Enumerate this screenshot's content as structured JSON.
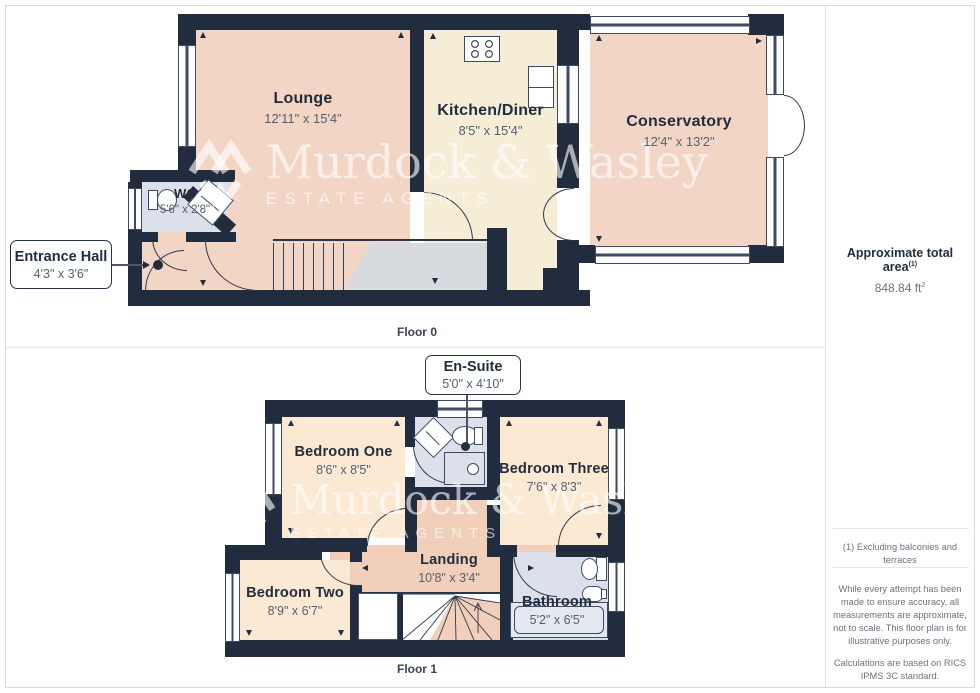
{
  "floor0": {
    "label": "Floor 0",
    "rooms": {
      "lounge": {
        "name": "Lounge",
        "dims": "12'11\" x 15'4\""
      },
      "kitchen": {
        "name": "Kitchen/Diner",
        "dims": "8'5\" x 15'4\""
      },
      "conservatory": {
        "name": "Conservatory",
        "dims": "12'4\" x 13'2\""
      },
      "wc": {
        "name": "WC",
        "dims": "5'6\" x 2'8\""
      },
      "entrance": {
        "name": "Entrance Hall",
        "dims": "4'3\" x 3'6\""
      }
    }
  },
  "floor1": {
    "label": "Floor 1",
    "rooms": {
      "ensuite": {
        "name": "En-Suite",
        "dims": "5'0\" x 4'10\""
      },
      "bedroom1": {
        "name": "Bedroom One",
        "dims": "8'6\" x 8'5\""
      },
      "bedroom3": {
        "name": "Bedroom Three",
        "dims": "7'6\" x 8'3\""
      },
      "bedroom2": {
        "name": "Bedroom Two",
        "dims": "8'9\" x 6'7\""
      },
      "landing": {
        "name": "Landing",
        "dims": "10'8\" x 3'4\""
      },
      "bathroom": {
        "name": "Bathroom",
        "dims": "5'2\" x 6'5\""
      }
    }
  },
  "sidebar": {
    "total_area_label": "Approximate total area",
    "total_area_sup": "(1)",
    "total_area_value": "848.84 ft",
    "total_area_value_sup": "2",
    "footnote": "(1) Excluding balconies and terraces",
    "disclaimer1": "While every attempt has been made to ensure accuracy, all measurements are approximate, not to scale. This floor plan is for illustrative purposes only.",
    "disclaimer2": "Calculations are based on RICS IPMS 3C standard.",
    "brand_name": "GIRAFFE",
    "brand_number": "360"
  },
  "watermark": {
    "name": "Murdock & Wasley",
    "tagline": "ESTATE AGENTS"
  },
  "colors": {
    "wall": "#212d3e",
    "room_warm": "#f3d5c5",
    "room_cream": "#f5edd6",
    "room_peach": "#fbe9d4",
    "room_wet": "#dbe0ea",
    "landing": "#f2cfba",
    "stairs_grey": "#d7dade"
  }
}
